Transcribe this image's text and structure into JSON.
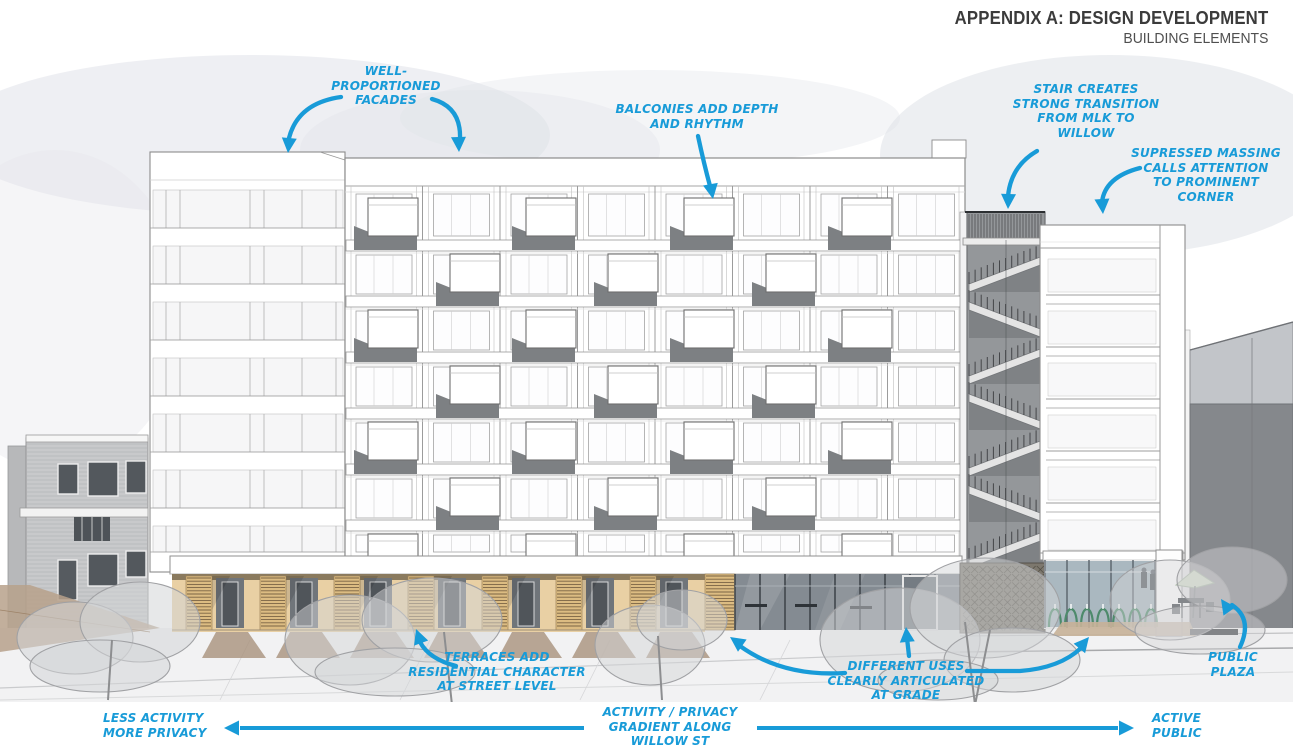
{
  "header": {
    "title": "APPENDIX A: DESIGN DEVELOPMENT",
    "subtitle": "BUILDING ELEMENTS"
  },
  "annotations": {
    "well_proportioned": "WELL-\nPROPORTIONED\nFACADES",
    "balconies": "BALCONIES ADD DEPTH\nAND RHYTHM",
    "stair": "STAIR CREATES\nSTRONG TRANSITION\nFROM MLK TO\nWILLOW",
    "suppressed_massing": "SUPRESSED MASSING\nCALLS ATTENTION\nTO PROMINENT\nCORNER",
    "terraces": "TERRACES ADD\nRESIDENTIAL CHARACTER\nAT STREET LEVEL",
    "different_uses": "DIFFERENT USES\nCLEARLY ARTICULATED\nAT GRADE",
    "public_plaza": "PUBLIC\nPLAZA"
  },
  "gradient_axis": {
    "left_label": "LESS ACTIVITY\nMORE PRIVACY",
    "center_label": "ACTIVITY / PRIVACY\nGRADIENT ALONG\nWILLOW ST",
    "right_label": "ACTIVE\nPUBLIC"
  },
  "colors": {
    "annotation_blue": "#189bd8",
    "title_color": "#3b3b3b",
    "wood_tan": "#e0bf87",
    "glass_dark": "#848b92",
    "glass_light": "#aab8c0",
    "bike_green": "#4d8a6b"
  }
}
